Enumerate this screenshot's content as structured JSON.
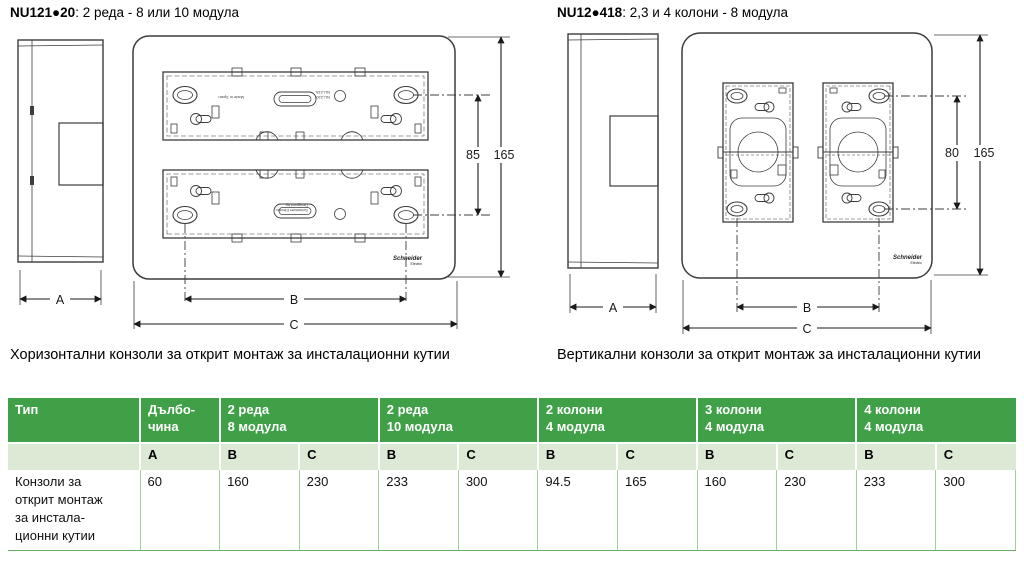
{
  "brand": {
    "line1": "Schneider",
    "line2": "Electric"
  },
  "figures": {
    "left": {
      "code": "NU121●20",
      "desc": ": 2 реда - 8 или 10 модула",
      "caption": "Хоризонтални конзоли за открит монтаж за инсталационни кутии",
      "dim_inner": "85",
      "dim_outer": "165",
      "dim_a": "A",
      "dim_b": "B",
      "dim_c": "C",
      "micro_line1": "Made in Spain",
      "micro_line2": "NU-218-",
      "micro_line3": "NU-220-",
      "micro_line4": "Designed by",
      "micro_line5": "Schneider Electric"
    },
    "right": {
      "code": "NU12●418",
      "desc": ": 2,3 и 4 колони - 8 модула",
      "caption": "Вертикални конзоли за открит монтаж за инсталационни кутии",
      "dim_inner": "80",
      "dim_outer": "165",
      "dim_a": "A",
      "dim_b": "B",
      "dim_c": "C"
    }
  },
  "table": {
    "type_header": "Тип",
    "groups": [
      {
        "label": "Дълбо-\nчина"
      },
      {
        "label": "2 реда\n8 модула"
      },
      {
        "label": "2 реда\n10 модула"
      },
      {
        "label": "2 колони\n4 модула"
      },
      {
        "label": "3 колони\n4 модула"
      },
      {
        "label": "4  колони\n4 модула"
      }
    ],
    "subheaders": [
      "A",
      "B",
      "C",
      "B",
      "C",
      "B",
      "C",
      "B",
      "C",
      "B",
      "C"
    ],
    "row_label": "Конзоли за\nоткрит монтаж\nза инстала-\nционни кутии",
    "values": [
      "60",
      "160",
      "230",
      "233",
      "300",
      "94.5",
      "165",
      "160",
      "230",
      "233",
      "300"
    ]
  },
  "colors": {
    "header_green": "#3fa047",
    "subheader_green": "#dcead5",
    "grid_green": "#a6cd9c",
    "line_dark": "#3c3c3c"
  }
}
